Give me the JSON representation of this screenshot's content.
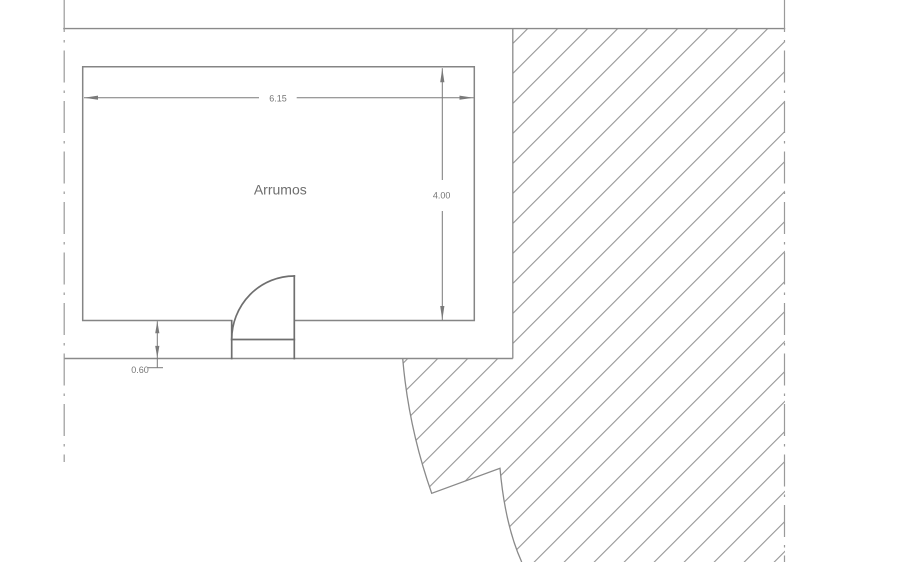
{
  "drawing": {
    "title": "floor-plan-detail",
    "room": {
      "label": "Arrumos"
    },
    "dimensions": {
      "width": {
        "value": "6.15"
      },
      "height": {
        "value": "4.00"
      },
      "offset": {
        "value": "0.60"
      }
    },
    "colors": {
      "background": "#ffffff",
      "wall_line": "#858585",
      "door_line": "#6f6f6f",
      "dimension_line": "#7a7a7a",
      "text": "#6e6e6e",
      "hatch_line": "#8f8f8f",
      "centerline": "#9a9a9a"
    }
  }
}
